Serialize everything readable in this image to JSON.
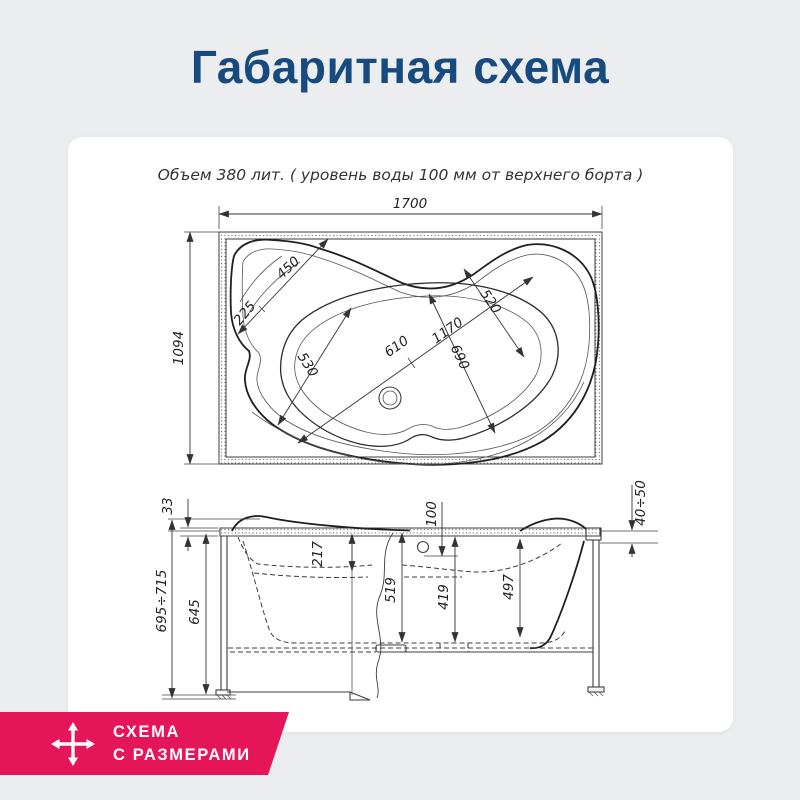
{
  "title": "Габаритная схема",
  "drawing": {
    "note": "Объем 380 лит. ( уровень воды 100 мм от верхнего борта )",
    "top_view": {
      "width": "1700",
      "depth": "1094",
      "headrest_offset": "225",
      "headrest_width": "450",
      "bowl_width_left": "530",
      "bowl_mid_length": "610",
      "bowl_length": "1170",
      "bowl_width_right": "690",
      "bowl_width_end": "520"
    },
    "front_view": {
      "rim_thickness": "33",
      "ledge_depth": "217",
      "overflow_offset": "100",
      "rim_range": "40÷50",
      "depth_left": "519",
      "depth_center": "419",
      "depth_right": "497",
      "height_body": "645",
      "height_range": "695÷715"
    }
  },
  "badge": {
    "line1": "СХЕМА",
    "line2": "С РАЗМЕРАМИ"
  },
  "colors": {
    "title": "#174a7e",
    "badge": "#e5155a",
    "background": "#ebedee",
    "panel": "#ffffff",
    "line": "#3c3c3c"
  }
}
